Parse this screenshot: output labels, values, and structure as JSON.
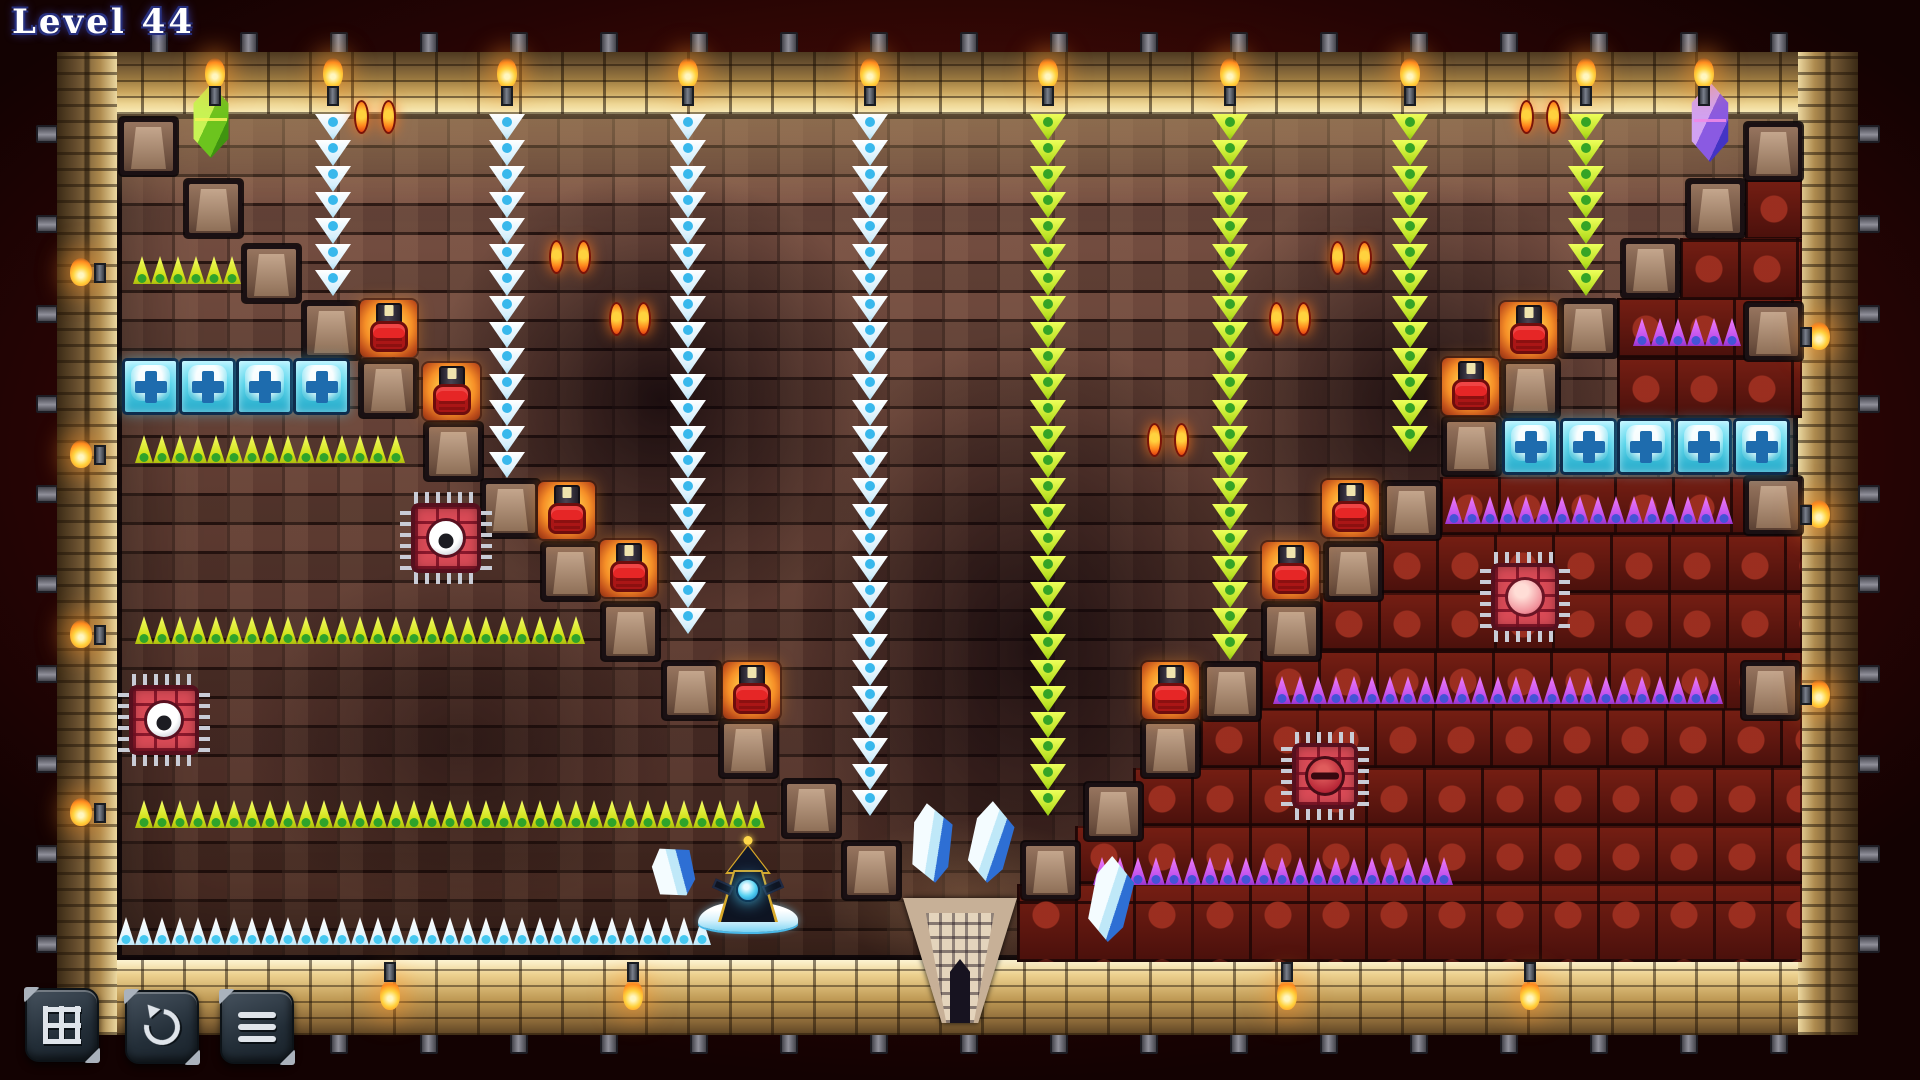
{
  "hud": {
    "level_label": "Level 44"
  },
  "toolbar": {
    "buttons": [
      {
        "id": "grid",
        "icon": "grid-icon"
      },
      {
        "id": "restart",
        "icon": "restart-icon"
      },
      {
        "id": "menu",
        "icon": "menu-icon"
      }
    ]
  },
  "palette": {
    "flame": "#ffd23e",
    "flame_deep": "#ff8a1e",
    "ice_spike": "#eef9ff",
    "ice_dot": "#3ec1ef",
    "green_spike": "#e8f23a",
    "green_dot": "#2fa32a",
    "purple_spike": "#d060ee",
    "purple_dot": "#4553d6",
    "cyan_block": "#56d4ea",
    "red_button": "#e62626",
    "stone_block": "#8a6a58",
    "red_zone": "#6a1a12",
    "eye_glow": "#ff8a1e",
    "wizard_orb": "#57d2f2"
  },
  "level": {
    "tile_size": 57,
    "gems": [
      {
        "id": "green-gem",
        "x": 188,
        "y": 84,
        "w": 46,
        "h": 74,
        "light": "#c8f455",
        "mid": "#6cc41e",
        "dark": "#3f9410",
        "line": "#f2f25a"
      },
      {
        "id": "purple-gem",
        "x": 1686,
        "y": 82,
        "w": 48,
        "h": 80,
        "light": "#d2a2f2",
        "mid": "#8a5ae2",
        "dark": "#4334c4",
        "line": "#ee8ae8"
      }
    ],
    "blocks": [
      [
        120,
        118
      ],
      [
        185,
        180
      ],
      [
        243,
        245
      ],
      [
        303,
        302
      ],
      [
        360,
        360
      ],
      [
        425,
        423
      ],
      [
        482,
        480
      ],
      [
        542,
        543
      ],
      [
        602,
        603
      ],
      [
        663,
        662
      ],
      [
        720,
        720
      ],
      [
        783,
        780
      ],
      [
        843,
        842
      ],
      [
        1022,
        842
      ],
      [
        1085,
        783
      ],
      [
        1142,
        720
      ],
      [
        1203,
        663
      ],
      [
        1263,
        603
      ],
      [
        1325,
        543
      ],
      [
        1383,
        482
      ],
      [
        1443,
        418
      ],
      [
        1502,
        360
      ],
      [
        1560,
        300
      ],
      [
        1622,
        240
      ],
      [
        1687,
        180
      ],
      [
        1745,
        123
      ],
      [
        1745,
        303
      ],
      [
        1745,
        477
      ],
      [
        1742,
        662
      ]
    ],
    "red_buttons": [
      [
        360,
        300
      ],
      [
        423,
        363
      ],
      [
        538,
        482
      ],
      [
        600,
        540
      ],
      [
        723,
        662
      ],
      [
        1142,
        662
      ],
      [
        1262,
        542
      ],
      [
        1322,
        480
      ],
      [
        1442,
        358
      ],
      [
        1500,
        302
      ]
    ],
    "cyan_rows": [
      {
        "y": 358,
        "xs": [
          122,
          179,
          236,
          293
        ]
      },
      {
        "y": 418,
        "xs": [
          1502,
          1560,
          1617,
          1675,
          1733
        ]
      }
    ],
    "spike_columns": [
      {
        "x": 333,
        "type": "ice",
        "y1": 114,
        "y2": 300
      },
      {
        "x": 507,
        "type": "ice",
        "y1": 114,
        "y2": 478
      },
      {
        "x": 688,
        "type": "ice",
        "y1": 114,
        "y2": 658
      },
      {
        "x": 870,
        "type": "ice",
        "y1": 114,
        "y2": 840
      },
      {
        "x": 1048,
        "type": "green",
        "y1": 114,
        "y2": 840
      },
      {
        "x": 1230,
        "type": "green",
        "y1": 114,
        "y2": 660
      },
      {
        "x": 1410,
        "type": "green",
        "y1": 114,
        "y2": 477
      },
      {
        "x": 1586,
        "type": "green",
        "y1": 114,
        "y2": 300
      }
    ],
    "spike_rows": [
      {
        "x": 133,
        "w": 108,
        "y": 256,
        "type": "green"
      },
      {
        "x": 135,
        "w": 284,
        "y": 435,
        "type": "green"
      },
      {
        "x": 135,
        "w": 466,
        "y": 616,
        "type": "green"
      },
      {
        "x": 135,
        "w": 644,
        "y": 800,
        "type": "green"
      },
      {
        "x": 117,
        "w": 594,
        "y": 917,
        "type": "ice"
      },
      {
        "x": 1633,
        "w": 108,
        "y": 318,
        "type": "purple"
      },
      {
        "x": 1445,
        "w": 296,
        "y": 496,
        "type": "purple"
      },
      {
        "x": 1273,
        "w": 466,
        "y": 676,
        "type": "purple"
      },
      {
        "x": 1093,
        "w": 368,
        "y": 857,
        "type": "purple"
      }
    ],
    "eye_pairs": [
      [
        354,
        100
      ],
      [
        549,
        240
      ],
      [
        609,
        302
      ],
      [
        1147,
        423
      ],
      [
        1269,
        302
      ],
      [
        1330,
        241
      ],
      [
        1519,
        100
      ]
    ],
    "chips": [
      {
        "x": 400,
        "y": 492,
        "size": 92,
        "eye": "white"
      },
      {
        "x": 118,
        "y": 674,
        "size": 92,
        "eye": "white"
      },
      {
        "x": 1480,
        "y": 552,
        "size": 90,
        "eye": "pink"
      },
      {
        "x": 1281,
        "y": 732,
        "size": 88,
        "eye": "slit"
      }
    ],
    "crystals": [
      {
        "x": 905,
        "y": 803,
        "w": 52,
        "h": 80,
        "tilt": -6
      },
      {
        "x": 964,
        "y": 801,
        "w": 52,
        "h": 82,
        "tilt": 4
      },
      {
        "x": 1084,
        "y": 856,
        "w": 52,
        "h": 86,
        "tilt": 3
      },
      {
        "x": 645,
        "y": 845,
        "w": 56,
        "h": 54,
        "tilt": -30
      }
    ],
    "door": {
      "x": 903,
      "y": 898,
      "w": 114,
      "h": 125
    },
    "wizard": {
      "x": 715,
      "y": 836,
      "w": 66,
      "h": 86,
      "frost": {
        "x": 698,
        "y": 902,
        "w": 100,
        "h": 30
      }
    },
    "red_region": [
      [
        1745,
        178,
        57,
        62
      ],
      [
        1680,
        238,
        122,
        62
      ],
      [
        1617,
        298,
        185,
        60
      ],
      [
        1617,
        358,
        185,
        60
      ],
      [
        1440,
        477,
        362,
        58
      ],
      [
        1378,
        535,
        424,
        58
      ],
      [
        1320,
        593,
        482,
        58
      ],
      [
        1260,
        651,
        542,
        60
      ],
      [
        1200,
        709,
        602,
        59
      ],
      [
        1133,
        768,
        669,
        58
      ],
      [
        1075,
        826,
        727,
        58
      ],
      [
        1017,
        884,
        785,
        78
      ]
    ],
    "torches": {
      "top": [
        215,
        333,
        507,
        688,
        870,
        1048,
        1230,
        1410,
        1586,
        1704
      ],
      "left": [
        258,
        440,
        620,
        798
      ],
      "right": [
        322,
        500,
        680
      ],
      "bottom": [
        390,
        633,
        1287,
        1530
      ]
    }
  }
}
